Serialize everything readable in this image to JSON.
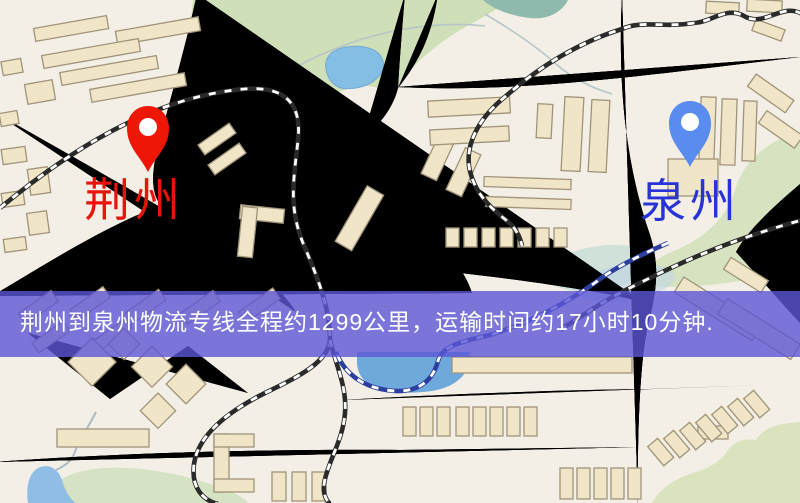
{
  "map": {
    "origin": {
      "name": "荆州",
      "pin_color": "#ee1607",
      "label_color": "#e8130b"
    },
    "destination": {
      "name": "泉州",
      "pin_color": "#5a8cf0",
      "label_color": "#2733d9"
    },
    "banner": {
      "text": "荆州到泉州物流专线全程约1299公里，运输时间约17小时10分钟.",
      "background": "#5c56d6",
      "text_color": "#ffffff"
    },
    "route": {
      "distance_text": "约1299公里",
      "duration_text": "约17小时10分钟"
    },
    "legend_colors": {
      "road": "#f3d47c",
      "railway": "#2a2a2a",
      "railway_alt": "#2d3f9e",
      "water": "#85bee4",
      "park": "#cfe0b8",
      "building": "#f0e6c7",
      "background": "#f4efe6"
    }
  }
}
